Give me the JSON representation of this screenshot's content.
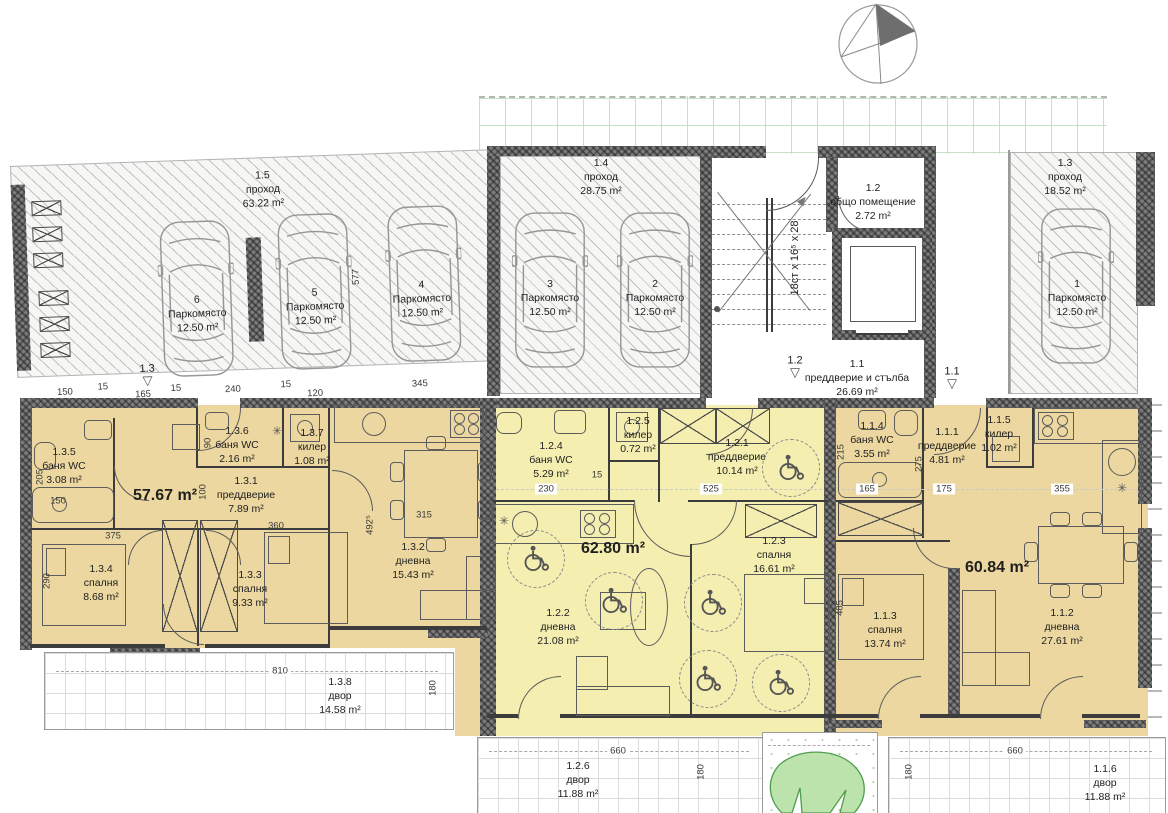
{
  "garage": {
    "zones": {
      "z15": {
        "id": "1.5",
        "name": "проход",
        "area": "63.22 m²"
      },
      "z14": {
        "id": "1.4",
        "name": "проход",
        "area": "28.75 m²"
      },
      "z13": {
        "id": "1.3",
        "name": "проход",
        "area": "18.52 m²"
      },
      "z12": {
        "id": "1.2",
        "name": "общо помещение",
        "area": "2.72 m²"
      },
      "z11": {
        "id": "1.1",
        "name": "преддверие и стълба",
        "area": "26.69 m²"
      }
    },
    "stairs_note": "18ст х 16⁵ х 28",
    "parking": [
      {
        "num": "6",
        "label": "Паркомясто",
        "area": "12.50 m²"
      },
      {
        "num": "5",
        "label": "Паркомясто",
        "area": "12.50 m²"
      },
      {
        "num": "4",
        "label": "Паркомясто",
        "area": "12.50 m²"
      },
      {
        "num": "3",
        "label": "Паркомясто",
        "area": "12.50 m²"
      },
      {
        "num": "2",
        "label": "Паркомясто",
        "area": "12.50 m²"
      },
      {
        "num": "1",
        "label": "Паркомясто",
        "area": "12.50 m²"
      }
    ],
    "entry_markers": {
      "m13": "1.3",
      "m12": "1.2",
      "m11": "1.1"
    }
  },
  "apartments": {
    "a3": {
      "total": "57.67 m²",
      "rooms": {
        "r135": {
          "id": "1.3.5",
          "name": "баня WC",
          "area": "3.08 m²"
        },
        "r136": {
          "id": "1.3.6",
          "name": "баня WC",
          "area": "2.16 m²"
        },
        "r137": {
          "id": "1.3.7",
          "name": "килер",
          "area": "1.08 m²"
        },
        "r131": {
          "id": "1.3.1",
          "name": "преддверие",
          "area": "7.89 m²"
        },
        "r134": {
          "id": "1.3.4",
          "name": "спалня",
          "area": "8.68 m²"
        },
        "r133": {
          "id": "1.3.3",
          "name": "спалня",
          "area": "9.33 m²"
        },
        "r132": {
          "id": "1.3.2",
          "name": "дневна",
          "area": "15.43 m²"
        },
        "r138": {
          "id": "1.3.8",
          "name": "двор",
          "area": "14.58 m²"
        }
      }
    },
    "a2": {
      "total": "62.80 m²",
      "rooms": {
        "r124": {
          "id": "1.2.4",
          "name": "баня WC",
          "area": "5.29 m²"
        },
        "r125": {
          "id": "1.2.5",
          "name": "килер",
          "area": "0.72 m²"
        },
        "r121": {
          "id": "1.2.1",
          "name": "преддверие",
          "area": "10.14 m²"
        },
        "r123": {
          "id": "1.2.3",
          "name": "спалня",
          "area": "16.61 m²"
        },
        "r122": {
          "id": "1.2.2",
          "name": "дневна",
          "area": "21.08 m²"
        },
        "r126": {
          "id": "1.2.6",
          "name": "двор",
          "area": "11.88 m²"
        }
      }
    },
    "a1": {
      "total": "60.84 m²",
      "rooms": {
        "r114": {
          "id": "1.1.4",
          "name": "баня WC",
          "area": "3.55 m²"
        },
        "r111": {
          "id": "1.1.1",
          "name": "преддверие",
          "area": "4.81 m²"
        },
        "r115": {
          "id": "1.1.5",
          "name": "килер",
          "area": "1.02 m²"
        },
        "r113": {
          "id": "1.1.3",
          "name": "спалня",
          "area": "13.74 m²"
        },
        "r112": {
          "id": "1.1.2",
          "name": "дневна",
          "area": "27.61 m²"
        },
        "r116": {
          "id": "1.1.6",
          "name": "двор",
          "area": "11.88 m²"
        }
      }
    }
  },
  "dims": {
    "g150": "150",
    "g15a": "15",
    "g165": "165",
    "g15b": "15",
    "g240": "240",
    "g15c": "15",
    "g120": "120",
    "g345": "345",
    "g577": "577",
    "a205": "205",
    "a290": "290",
    "a150": "150",
    "a90": "90",
    "a100": "100",
    "a375": "375",
    "a360": "360",
    "a492": "492⁵",
    "a315": "315",
    "y810": "810",
    "y180a": "180",
    "b230": "230",
    "b15": "15",
    "b525": "525",
    "c215": "215",
    "c165": "165",
    "c275": "275",
    "c175": "175",
    "c355": "355",
    "c485": "485",
    "y660a": "660",
    "y180b": "180",
    "y660b": "660",
    "y180c": "180"
  },
  "colors": {
    "apartment_tan": "#ebd79f",
    "apartment_yellow": "#f4eeb0",
    "wall": "#7d7d7d",
    "grid_green": "#c6e2c6",
    "grass_green": "#bce3ab"
  }
}
